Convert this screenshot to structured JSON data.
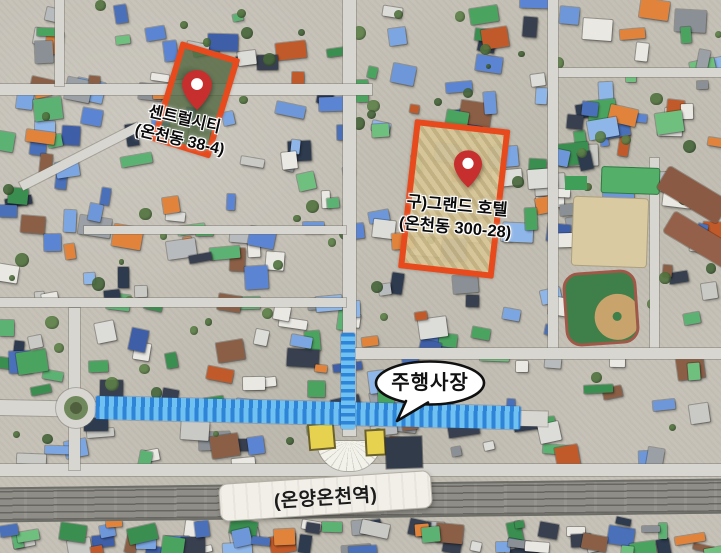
{
  "map": {
    "type": "satellite-annotated",
    "sites": [
      {
        "label_line1": "센트럴시티",
        "label_line2": "(온천동 38-4)"
      },
      {
        "label_line1": "구)그랜드 호텔",
        "label_line2": "(온천동 300-28)"
      }
    ],
    "callout": {
      "text": "주행사장"
    },
    "station": {
      "label": "(온양온천역)"
    },
    "colors": {
      "site_outline": "#e64a1d",
      "pin": "#c62f2e",
      "route_stripe_dark": "#2e84d6",
      "route_stripe_light": "#6fc1f2"
    }
  }
}
